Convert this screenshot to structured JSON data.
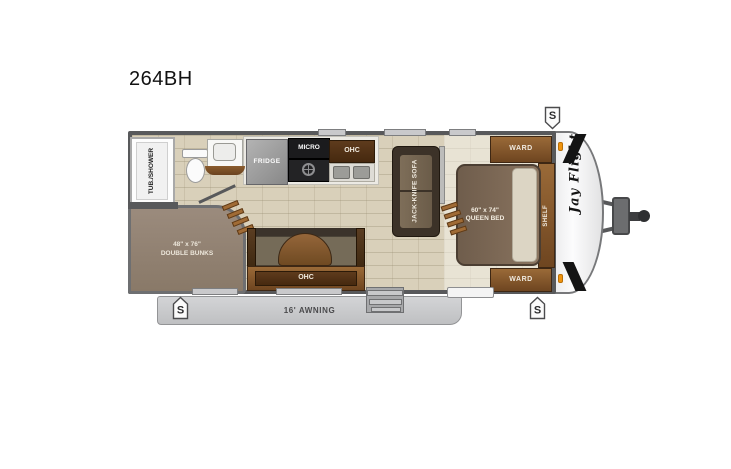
{
  "page": {
    "model_title": "264BH"
  },
  "floorplan": {
    "brand_logo": "Jay Flight",
    "badge_letter": "S",
    "labels": {
      "tub_shower": "TUB./SHOWER",
      "fridge": "FRIDGE",
      "micro": "MICRO",
      "kitchen_ohc": "OHC",
      "sofa": "JACK-KNIFE SOFA",
      "ward_top": "WARD",
      "ward_bottom": "WARD",
      "shelf": "SHELF",
      "queen_bed_size": "60\" x 74\"",
      "queen_bed_name": "QUEEN BED",
      "bunks_size": "48\" x 76\"",
      "bunks_name": "DOUBLE BUNKS",
      "dinette_ohc": "OHC",
      "awning": "16' AWNING"
    },
    "colors": {
      "wall": "#58595b",
      "floor_tile": "#d9d0ba",
      "cabinet_wood": "#6e4520",
      "awning_gray": "#c9cacb",
      "marker_light_orange": "#f0940f"
    }
  }
}
